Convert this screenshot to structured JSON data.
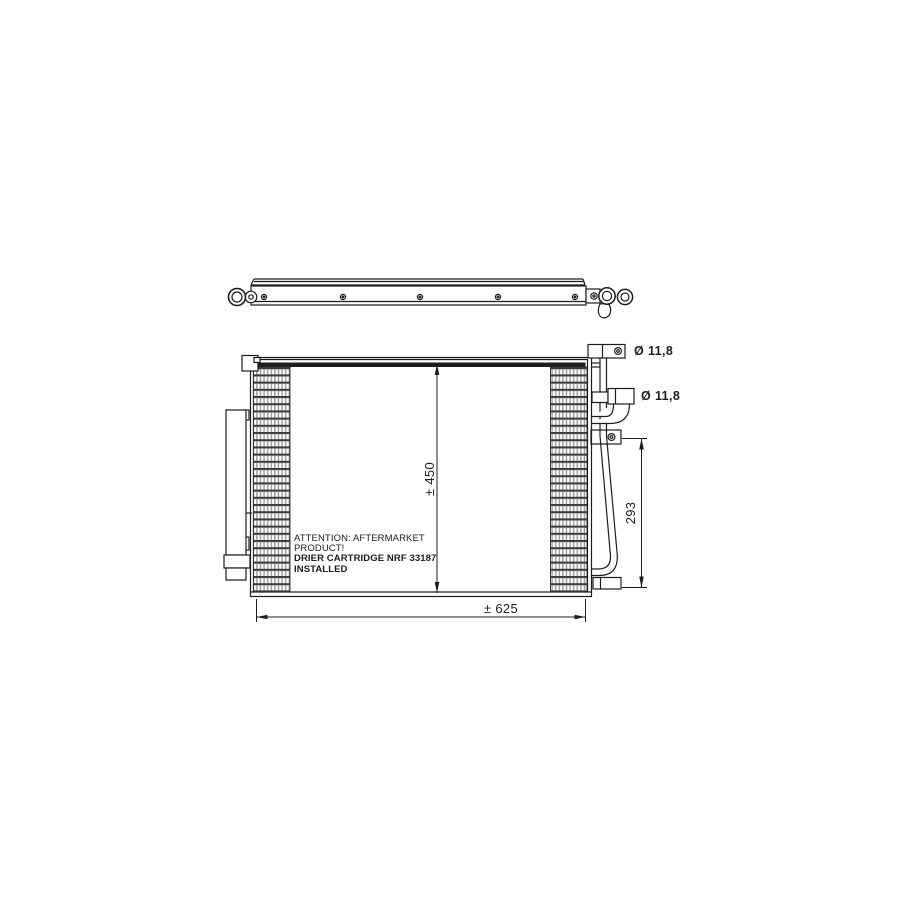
{
  "drawing": {
    "colors": {
      "line": "#1d1d1d",
      "background": "#ffffff"
    },
    "labels": {
      "port_top_diameter": "Ø 11,8",
      "port_mid_diameter": "Ø 11,8",
      "pipe_span": "293",
      "core_height": "± 450",
      "core_width": "± 625"
    },
    "attention_note": {
      "line1": "ATTENTION: AFTERMARKET",
      "line2": "PRODUCT!",
      "line3": "DRIER CARTRIDGE NRF 33187",
      "line4": "INSTALLED"
    }
  }
}
